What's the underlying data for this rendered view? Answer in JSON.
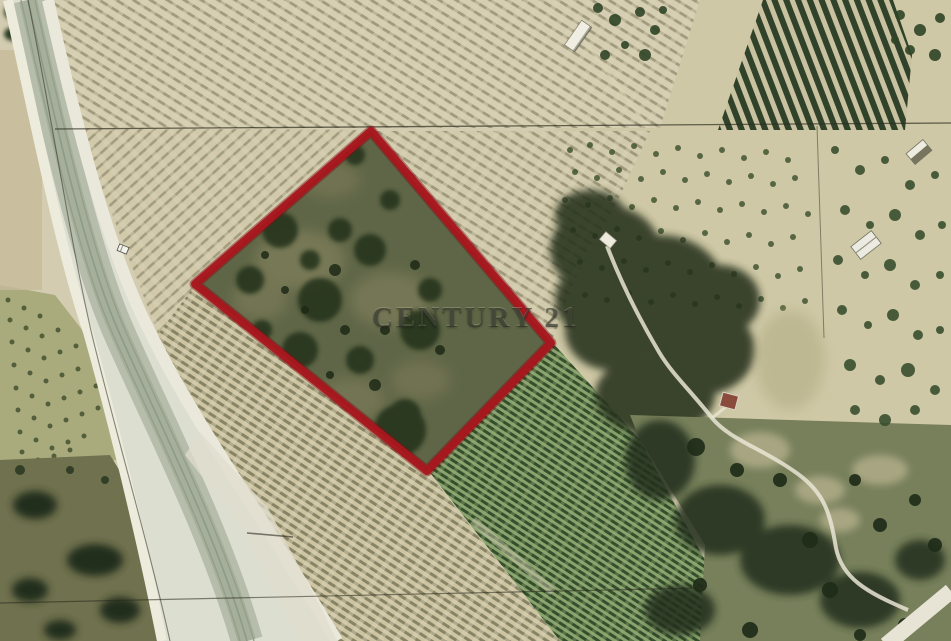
{
  "watermark": {
    "text": "CENTURY 21"
  },
  "colors": {
    "boundary_red": "#a8161d",
    "field_beige": "#d5cdb2",
    "vineyard_green": "#89a36e",
    "woodland_dark": "#25331e",
    "road_light": "#dcded0",
    "watermark_ink": "rgba(40,45,33,0.60)"
  }
}
